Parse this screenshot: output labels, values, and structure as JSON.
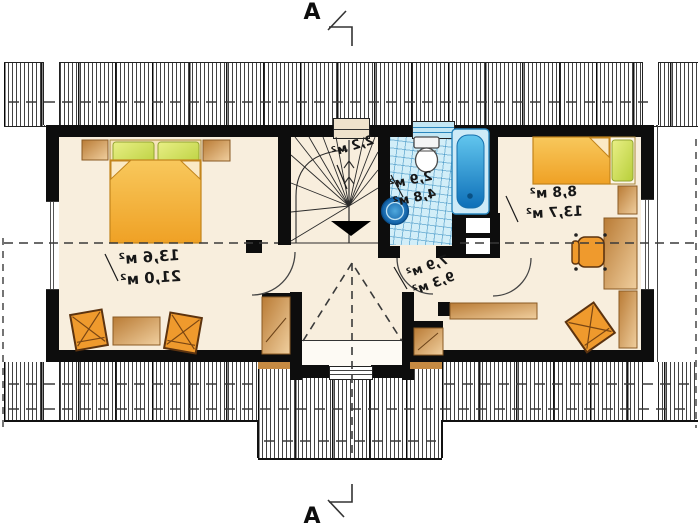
{
  "section_markers": {
    "top": "A",
    "bottom": "A"
  },
  "room_labels": {
    "bedroom_left": {
      "area": "13,6 м²",
      "floor_area": "21,0 м²"
    },
    "staircase": {
      "area": "2,2 м²"
    },
    "bathroom": {
      "area": "2,9 м²",
      "floor_area": "4,8 м²"
    },
    "hall": {
      "area": "7,9 м²",
      "floor_area": "9,3 м²"
    },
    "bedroom_right": {
      "area": "8,8 м²",
      "floor_area": "13,7 м²"
    }
  },
  "colors": {
    "wall": "#0d0d0d",
    "floor": "#f8eedd",
    "bathroom_tile": "#d2eef8",
    "water_blue": "#2f9fd8",
    "furniture_orange": "#f0a028",
    "pillow_green": "#c8d844",
    "wood_tan": "#cf9454"
  }
}
